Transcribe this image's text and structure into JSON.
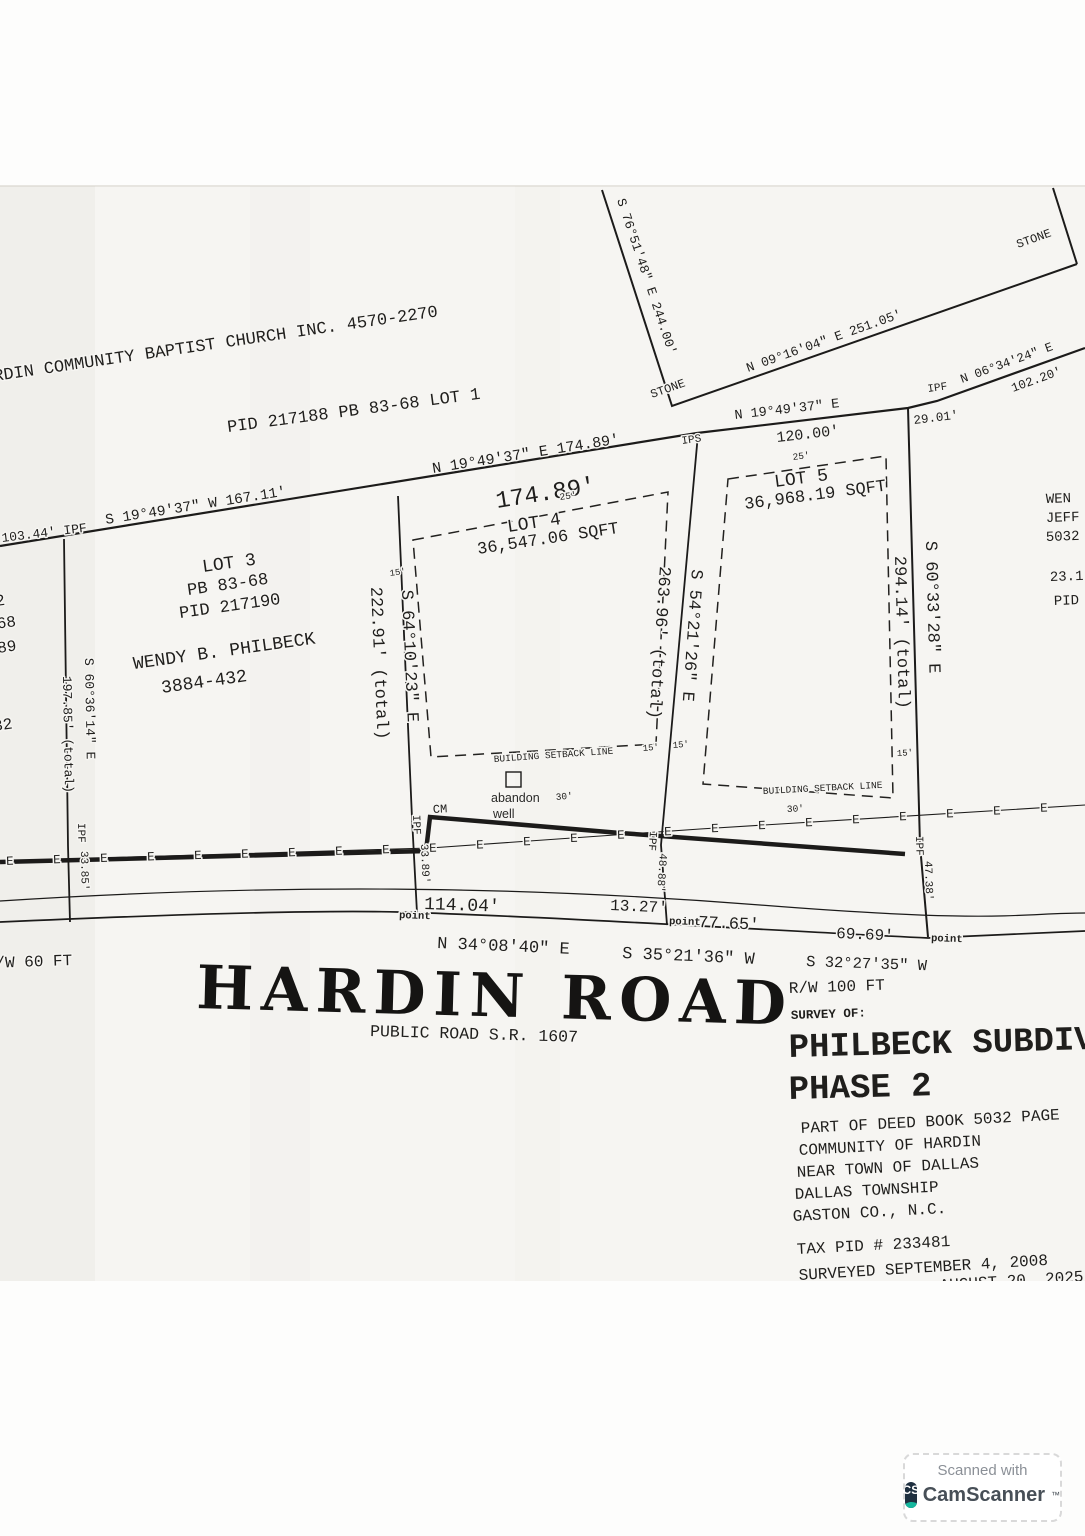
{
  "symbols": {
    "ipf": "IPF",
    "ips": "IPS",
    "stone": "STONE",
    "point": "point",
    "e": "E",
    "cm": "CM",
    "d15": "15'",
    "d25": "25'",
    "d30": "30'",
    "setback": "BUILDING SETBACK LINE",
    "well1": "abandon",
    "well2": "well"
  },
  "adjoining": {
    "church_owner": "HARDIN COMMUNITY BAPTIST CHURCH INC.   4570-2270",
    "church_parcel": "PID 217188   PB 83-68   LOT 1",
    "east_fragments": {
      "f1": "WEN",
      "f2": "JEFF",
      "f3": "5032",
      "f4": "23.1",
      "f5": "PID"
    },
    "west_fragments": {
      "f1": "2",
      "f2": "-68",
      "f3": "89",
      "f4": "32"
    }
  },
  "bearings": {
    "n_boundary": "S 19°49'37\" W   167.11'",
    "tie_left": "103.44'  IPF",
    "lot4_front": "N 19°49'37\" E  174.89'",
    "lot4_front_dist": "174.89'",
    "lot5_front": "N 19°49'37\" E",
    "lot5_front_dist": "120.00'",
    "tie_right_dist": "29.01'",
    "ne_bearing": "N 06°34'24\" E",
    "ne_dist": "102.20'",
    "stone_bearing": "N 09°16'04\" E  251.05'",
    "west_stone_bearing": "S 76°51'48\" E  244.00'"
  },
  "lot3": {
    "name": "LOT 3",
    "pb": "PB 83-68",
    "pid": "PID 217190",
    "owner": "WENDY B. PHILBECK",
    "deed": "3884-432",
    "west_bearing": "S 60°36'14\" E",
    "west_dist": "197.85' (total)",
    "west_tie": "33.85'",
    "east_dist": "222.91' (total)",
    "east_bearing": "S 64°10'23\" E",
    "east_tie": "33.89'"
  },
  "lot4": {
    "name": "LOT 4",
    "area": "36,547.06 SQFT",
    "east_dist": "263.96' (total)",
    "east_bearing": "S 54°21'26\" E",
    "east_tie": "48.88'"
  },
  "lot5": {
    "name": "LOT 5",
    "area": "36,968.19 SQFT",
    "east_dist": "294.14' (total)",
    "east_bearing": "S 60°33'28\" E",
    "east_tie": "47.38'"
  },
  "road": {
    "name": "HARDIN ROAD",
    "designation": "PUBLIC ROAD S.R. 1607",
    "rw_left": "R/W 60 FT",
    "rw_right": "R/W 100 FT",
    "d1": "114.04'",
    "d2": "13.27'",
    "d3": "77.65'",
    "d4": "69.69'",
    "b1": "N 34°08'40\" E",
    "b2": "S 35°21'36\" W",
    "b3": "S 32°27'35\" W"
  },
  "title_block": {
    "survey_of": "SURVEY OF:",
    "name1": "PHILBECK SUBDIVISION",
    "name2": "PHASE 2",
    "deed_ref": "PART OF DEED BOOK 5032 PAGE",
    "loc1": "COMMUNITY OF HARDIN",
    "loc2": "NEAR TOWN OF DALLAS",
    "loc3": "DALLAS TOWNSHIP",
    "loc4": "GASTON CO., N.C.",
    "tax": "TAX PID # 233481",
    "surveyed": "SURVEYED SEPTEMBER 4, 2008",
    "revision_partial": "AUGUST 20, 2025"
  },
  "watermark": {
    "line1": "Scanned with",
    "brand": "CamScanner",
    "tm": "™",
    "logo": "CS"
  }
}
